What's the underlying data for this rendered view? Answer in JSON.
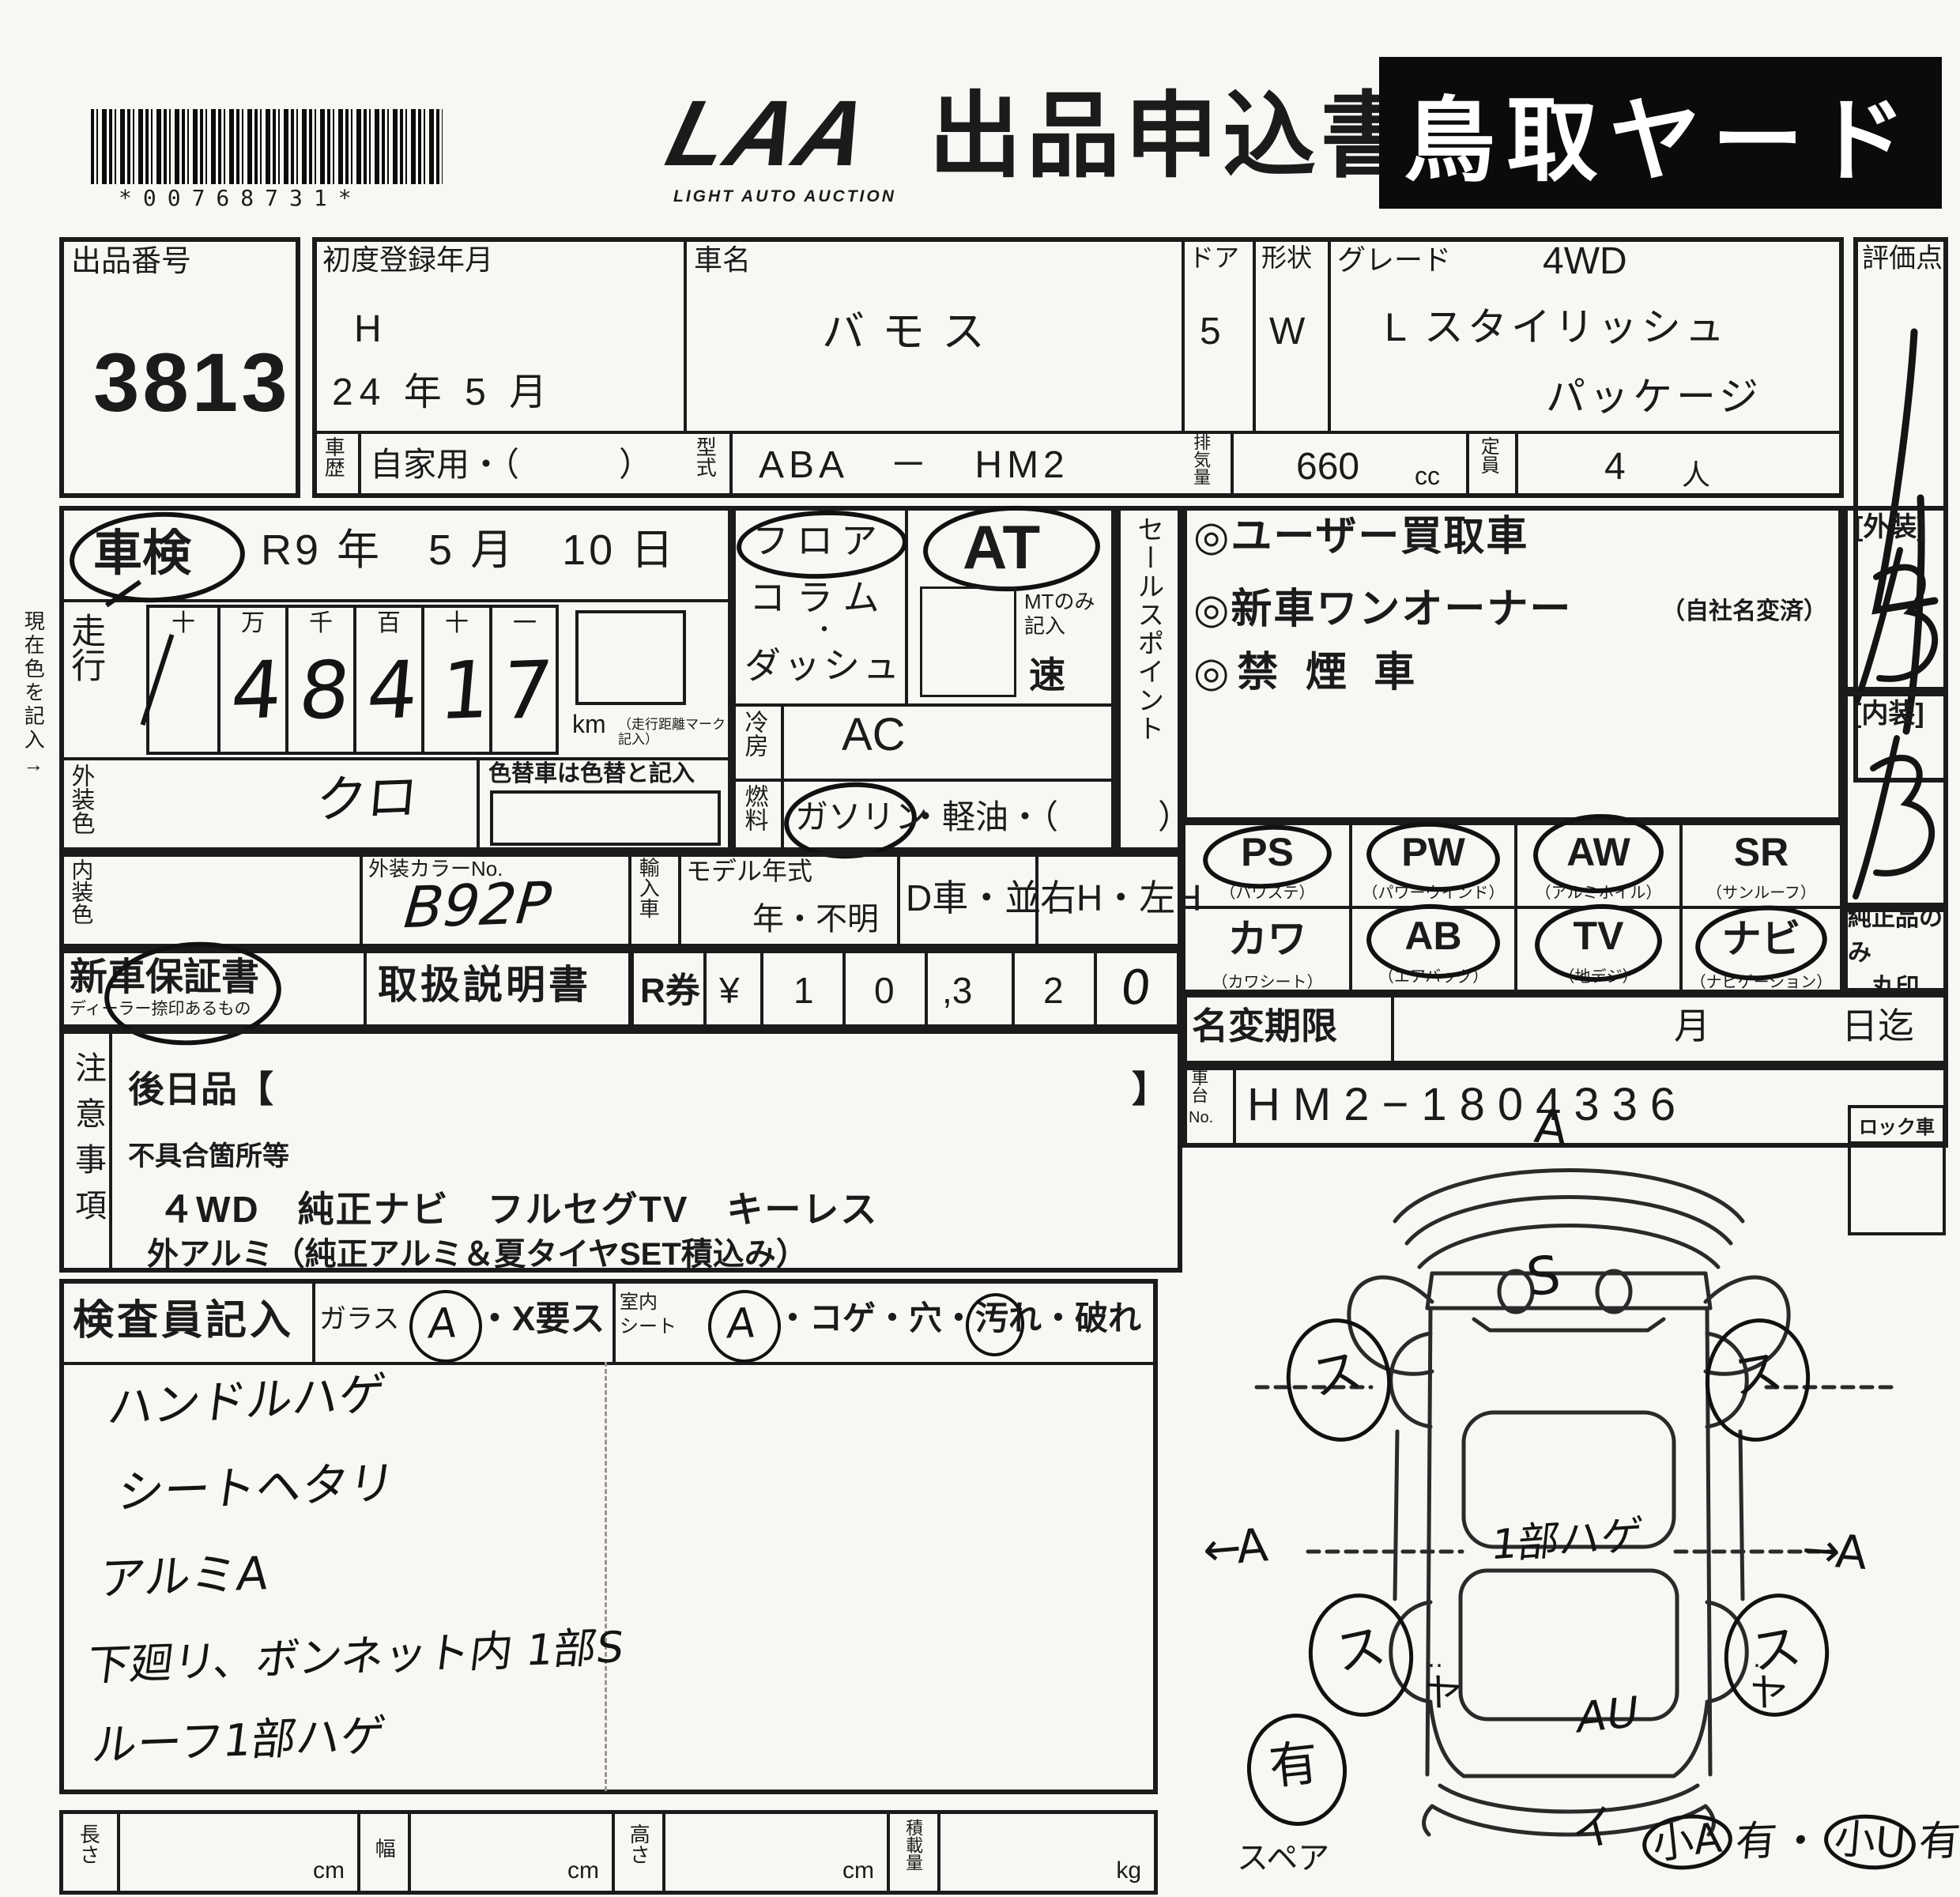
{
  "header": {
    "barcode_text": "*00768731*",
    "logo_main": "LAA",
    "logo_sub": "LIGHT AUTO AUCTION",
    "form_title": "出品申込書",
    "yard_name": "鳥取ヤード"
  },
  "lot": {
    "label": "出品番号",
    "number": "3813"
  },
  "first_reg": {
    "label": "初度登録年月",
    "era": "H",
    "date": "24 年 5 月"
  },
  "car_name": {
    "label": "車名",
    "value": "バモス"
  },
  "doors": {
    "label": "ドア",
    "value": "5"
  },
  "body_shape": {
    "label": "形状",
    "value": "W"
  },
  "grade": {
    "label": "グレード",
    "drive": "4WD",
    "line1": "L スタイリッシュ",
    "line2": "パッケージ"
  },
  "score": {
    "label": "評価点",
    "value": "4"
  },
  "history": {
    "label": "車歴",
    "value": "自家用・（　　　）"
  },
  "model_code": {
    "label": "型式",
    "value": "ABA　－　HM2"
  },
  "displacement": {
    "label": "排気量",
    "value": "660",
    "unit": "cc"
  },
  "capacity": {
    "label": "定員",
    "value": "4",
    "unit": "人"
  },
  "margin_note": "現在色を記入→",
  "inspection": {
    "label": "車検",
    "value": "R9 年　5 月　10 日"
  },
  "mileage": {
    "label": "走行",
    "digit_headers": [
      "十",
      "万",
      "千",
      "百",
      "十",
      "一"
    ],
    "digits": [
      "",
      "4",
      "8",
      "4",
      "1",
      "7"
    ],
    "unit": "km",
    "unit_note": "（走行距離マーク記入）"
  },
  "ext_color": {
    "label": "外装色",
    "value": "クロ",
    "change_note": "色替車は色替と記入"
  },
  "shift": {
    "floor": "フロア",
    "column": "コラム",
    "dot": "・",
    "dash": "ダッシュ",
    "at": "AT",
    "mt_note": "MTのみ記入",
    "speed": "速"
  },
  "cooling": {
    "label": "冷房",
    "value": "AC"
  },
  "fuel": {
    "label": "燃料",
    "gasoline": "ガソリン",
    "others": "・軽油・（　　　）"
  },
  "sales_points": {
    "vertical_label": "セールスポイント",
    "item1": "◎ユーザー買取車",
    "item2": "◎新車ワンオーナー",
    "item2_note": "（自社名変済）",
    "item3": "◎禁 煙 車"
  },
  "grades": {
    "exterior_label": "[外装]",
    "exterior_value": "B",
    "interior_label": "[内装]",
    "interior_value": "B"
  },
  "equipment": {
    "row1": [
      {
        "code": "PS",
        "name": "（パワステ）",
        "circled": true
      },
      {
        "code": "PW",
        "name": "（パワーウインド）",
        "circled": true
      },
      {
        "code": "AW",
        "name": "（アルミホイル）",
        "circled": true
      },
      {
        "code": "SR",
        "name": "（サンルーフ）",
        "circled": false
      }
    ],
    "row2": [
      {
        "code": "カワ",
        "name": "（カワシート）",
        "circled": false
      },
      {
        "code": "AB",
        "name": "（エアバッグ）",
        "circled": true
      },
      {
        "code": "TV",
        "name": "（地デジ）",
        "circled": true
      },
      {
        "code": "ナビ",
        "name": "（ナビゲーション）",
        "circled": true
      }
    ],
    "genuine_line1": "純正品のみ",
    "genuine_line2": "丸印"
  },
  "int_color": {
    "label": "内装色"
  },
  "color_no": {
    "label": "外装カラーNo.",
    "value": "B92P"
  },
  "import_car": {
    "label": "輸入車"
  },
  "model_year": {
    "label": "モデル年式",
    "value": "年・不明"
  },
  "dealer_car": {
    "label": "D車・並"
  },
  "handle": {
    "label": "右H・左H"
  },
  "warranty": {
    "label": "新車保証書",
    "sub": "ディーラー捺印あるもの"
  },
  "manual": {
    "label": "取扱説明書"
  },
  "recycle": {
    "label": "R券",
    "yen": "¥",
    "digits": [
      "1",
      "0",
      ",3",
      "2"
    ],
    "hand_digit": "0"
  },
  "name_change": {
    "label": "名変期限",
    "month": "月",
    "until": "日迄"
  },
  "chassis": {
    "label_top": "車台",
    "label_no": "No.",
    "value": "HM2−1804336"
  },
  "cautions": {
    "vertical_label": "注意事項",
    "later_label": "後日品【",
    "later_close": "】",
    "defect_label": "不具合箇所等",
    "line1": "４WD　純正ナビ　フルセグTV　キーレス",
    "line2": "外アルミ（純正アルミ＆夏タイヤSET積込み）"
  },
  "inspector": {
    "label": "検査員記入",
    "glass_label": "ガラス",
    "glass_mark": "A",
    "glass_options": "・X要ス",
    "seat_label_1": "室内",
    "seat_label_2": "シート",
    "seat_mark": "A",
    "seat_opt_pre": "・コゲ・穴・",
    "seat_opt_circled": "汚",
    "seat_opt_post": "れ・破れ",
    "notes": [
      "ハンドルハゲ",
      "シートヘタリ",
      "アルミA",
      "下廻リ、ボンネット内 1部S",
      "ルーフ1部ハゲ"
    ]
  },
  "measure": {
    "length": "長さ",
    "width": "幅",
    "height": "高さ",
    "load": "積載量",
    "cm": "cm",
    "kg": "kg"
  },
  "lock": {
    "label": "ロック車"
  },
  "diagram": {
    "spare": "スペア",
    "marks": {
      "front_top": "A",
      "windshield": "S",
      "wheel_fl": "ス",
      "wheel_fr": "ス",
      "wheel_rl": "ス",
      "wheel_rr": "ス",
      "side_left": "←A",
      "side_right": "→A",
      "center": "1部ハゲ",
      "panel_left": "ヤ",
      "panel_right": "ヤ",
      "rear_window": "AU",
      "spare_present": "有",
      "rear_bumper": "イ",
      "br_1": "小A",
      "br_2": "有",
      "br_3": "・",
      "br_4": "小U",
      "br_5": "有"
    }
  }
}
